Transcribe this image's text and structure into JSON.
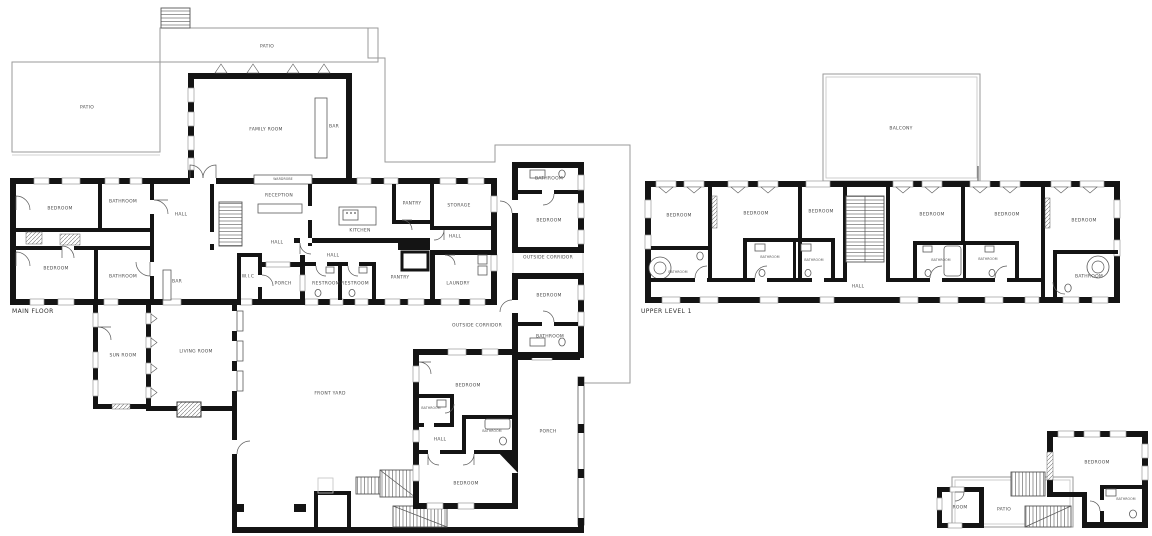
{
  "document_title": "Residence floor plans",
  "colors": {
    "wall": "#141414",
    "background": "#ffffff",
    "thin_outline": "#9a9a9a"
  },
  "main_floor": {
    "title": "MAIN FLOOR",
    "patio_top": "PATIO",
    "patio_left": "PATIO",
    "family_room": "FAMILY ROOM",
    "bar_family": "BAR",
    "bedroom_nw": "BEDROOM",
    "bathroom_nw": "BATHROOM",
    "hall_nw": "HALL",
    "wardrobe": "WARDROBE",
    "reception": "RECEPTION",
    "hall_mid": "HALL",
    "bedroom_sw": "BEDROOM",
    "bathroom_sw": "BATHROOM",
    "bar_small": "BAR",
    "wic": "W.I.C",
    "porch_nw": "PORCH",
    "kitchen": "KITCHEN",
    "pantry_n": "PANTRY",
    "storage": "STORAGE",
    "hall_ne": "HALL",
    "hall_s": "HALL",
    "restroom_1": "RESTROOM",
    "restroom_2": "RESTROOM",
    "pantry_s": "PANTRY",
    "laundry": "LAUNDRY",
    "outside_corridor_e": "OUTSIDE CORRIDOR",
    "bathroom_g1": "BATHROOM",
    "bedroom_g1": "BEDROOM",
    "bedroom_g2": "BEDROOM",
    "bathroom_g2": "BATHROOM",
    "outside_corridor_s": "OUTSIDE CORRIDOR",
    "sun_room": "SUN ROOM",
    "living_room": "LIVING ROOM",
    "front_yard": "FRONT YARD",
    "bedroom_s1": "BEDROOM",
    "bathroom_s1": "BATHROOM",
    "hall_sw": "HALL",
    "bathroom_s2": "BATHROOM",
    "bedroom_s2": "BEDROOM",
    "porch_e": "PORCH"
  },
  "upper_level": {
    "title": "UPPER LEVEL 1",
    "balcony": "BALCONY",
    "bedroom_1": "BEDROOM",
    "bedroom_2": "BEDROOM",
    "bedroom_3": "BEDROOM",
    "bedroom_4": "BEDROOM",
    "bedroom_5": "BEDROOM",
    "bedroom_6": "BEDROOM",
    "bathroom_1": "BATHROOM",
    "bathroom_2": "BATHROOM",
    "bathroom_3": "BATHROOM",
    "bathroom_4": "BATHROOM",
    "bathroom_5": "BATHROOM",
    "bathroom_6": "BATHROOM",
    "hall": "HALL"
  },
  "outbuilding": {
    "bedroom": "BEDROOM",
    "bathroom": "BATHROOM",
    "patio": "PATIO",
    "room": "ROOM"
  }
}
